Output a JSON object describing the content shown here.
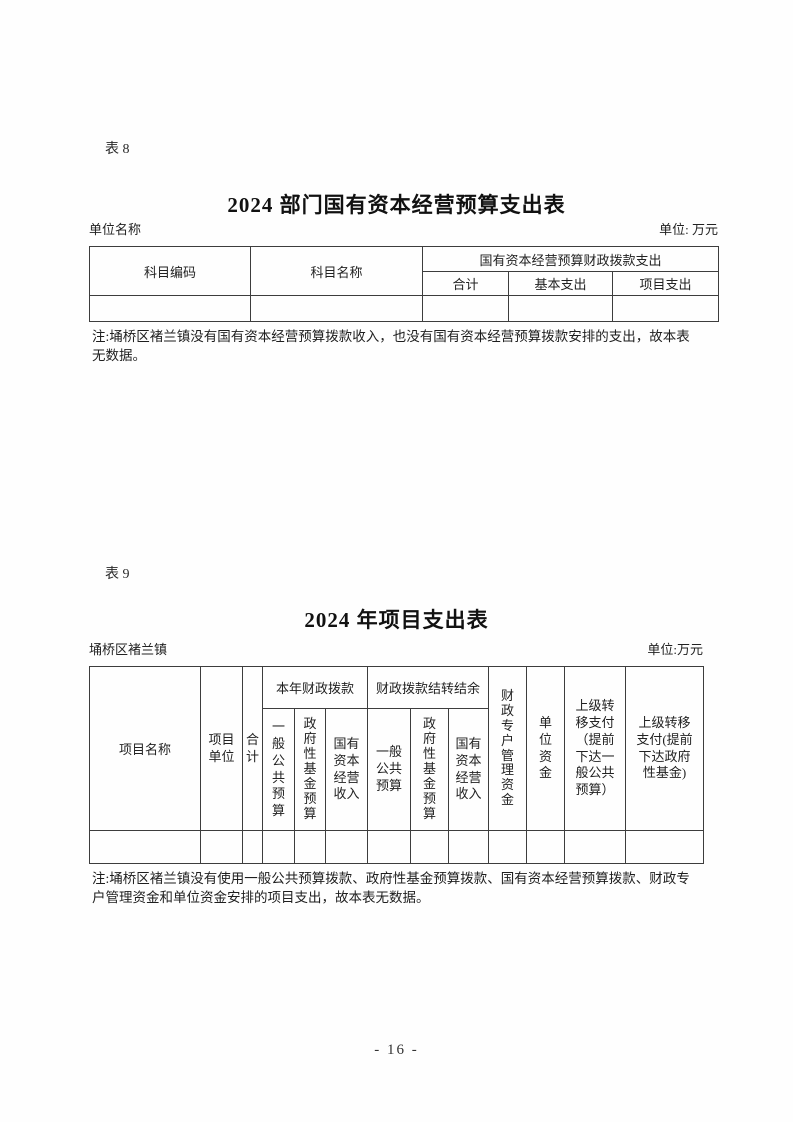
{
  "page": {
    "number": "- 16 -"
  },
  "table8": {
    "tag": "表 8",
    "title": "2024 部门国有资本经营预算支出表",
    "meta_left": "单位名称",
    "meta_right": "单位: 万元",
    "head": {
      "subject_code": "科目编码",
      "subject_name": "科目名称",
      "group_soc_allocation_expenditure": "国有资本经营预算财政拨款支出",
      "total": "合计",
      "basic_expenditure": "基本支出",
      "project_expenditure": "项目支出"
    },
    "data_row": [
      "",
      "",
      "",
      "",
      ""
    ],
    "note": "注:埇桥区褚兰镇没有国有资本经营预算拨款收入，也没有国有资本经营预算拨款安排的支出，故本表\n无数据。"
  },
  "table9": {
    "tag": "表 9",
    "title": "2024 年项目支出表",
    "meta_left": "埇桥区褚兰镇",
    "meta_right": "单位:万元",
    "head": {
      "project_name": "项目名称",
      "project_unit": "项目\n单位",
      "total": "合\n计",
      "group_current_year_allocation": "本年财政拨款",
      "cur_general_public_budget": "一\n般\n公\n共\n预\n算",
      "cur_gov_fund_budget": "政\n府\n性\n基\n金\n预\n算",
      "cur_soc_operating_income": "国有\n资本\n经营\n收入",
      "group_allocation_carryover": "财政拨款结转结余",
      "co_general_public_budget": "一般\n公共\n预算",
      "co_gov_fund_budget": "政\n府\n性\n基\n金\n预\n算",
      "co_soc_operating_income": "国有\n资本\n经营\n收入",
      "fiscal_special_account_funds": "财\n政\n专\n户\n管\n理\n资\n金",
      "unit_funds": "单\n位\n资\n金",
      "transfer_general_budget": "上级转\n移支付\n（提前\n下达一\n般公共\n预算）",
      "transfer_gov_fund": "上级转移\n支付(提前\n下达政府\n性基金)"
    },
    "data_row": [
      "",
      "",
      "",
      "",
      "",
      "",
      "",
      "",
      "",
      "",
      "",
      "",
      ""
    ],
    "note": "注:埇桥区褚兰镇没有使用一般公共预算拨款、政府性基金预算拨款、国有资本经营预算拨款、财政专\n户管理资金和单位资金安排的项目支出，故本表无数据。"
  }
}
